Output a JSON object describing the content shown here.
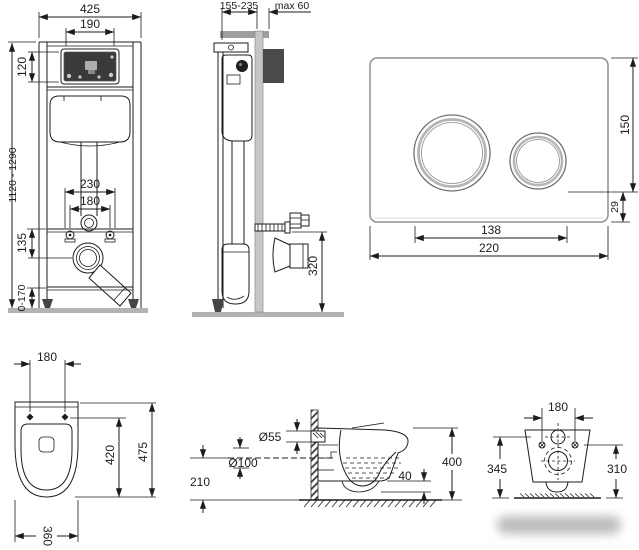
{
  "drawing_title": "wall-hung toilet installation frame, flush plate and bowl dimensions",
  "views": {
    "frame_front": {
      "width": "425",
      "opening_width": "190",
      "opening_height": "120",
      "install_height": "1120 - 1290",
      "fixing_width": "230",
      "fixing_inner": "180",
      "drain_offset": "135",
      "foot_adjust": "0-170"
    },
    "frame_side": {
      "depth": "155-235",
      "wall_max": "max 60",
      "drain_height": "320"
    },
    "flush_plate": {
      "height": "150",
      "edge_offset": "29",
      "button_span": "138",
      "width": "220"
    },
    "bowl_top": {
      "fixing": "180",
      "depth": "475",
      "inner_depth": "420",
      "width": "360"
    },
    "bowl_side": {
      "inlet": "Ø55",
      "outlet": "Ø100",
      "outlet_height": "210",
      "trap_gap": "40",
      "height": "400"
    },
    "bowl_rear": {
      "fixing": "180",
      "inlet_height": "345",
      "fixing_height": "310"
    }
  },
  "colors": {
    "line": "#1c1c1c",
    "floor_gray": "#b3b3b3",
    "wall_gray": "#c6c6c6",
    "panel_dark": "#3a3a3a",
    "watermark_blur": "#bcbcbc"
  }
}
